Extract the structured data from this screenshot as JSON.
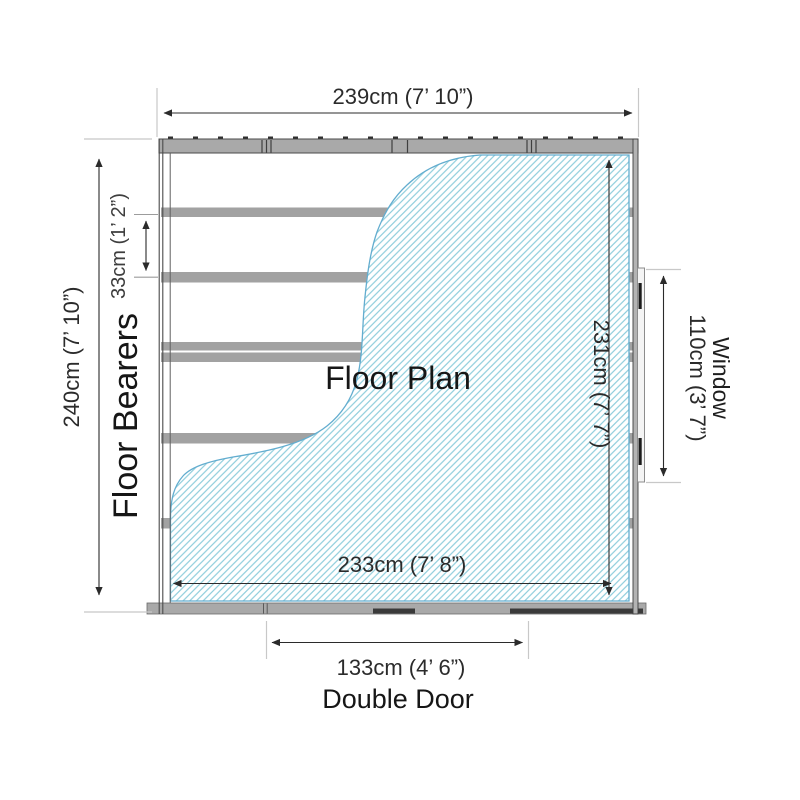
{
  "plan": {
    "title": "Floor Plan",
    "labels": {
      "floor_bearers": "Floor Bearers",
      "window": "Window",
      "double_door": "Double Door"
    },
    "dimensions": {
      "overall_width": "239cm (7’ 10”)",
      "overall_depth": "240cm (7’ 10”)",
      "bearer_spacing": "33cm (1’ 2”)",
      "internal_depth": "231cm (7’ 7”)",
      "window_width": "110cm (3’ 7”)",
      "internal_width": "233cm (7’ 8”)",
      "door_width": "133cm (4’ 6”)"
    },
    "colors": {
      "hatch_line": "#8ecddc",
      "hatch_edge": "#63adcf",
      "wall_gray": "#a9a9a9",
      "bearer_gray": "#a2a2a2",
      "dimension_line": "#2b2b2b",
      "extension_gray": "#c8c8c8",
      "text": "#2b2b2b"
    }
  }
}
